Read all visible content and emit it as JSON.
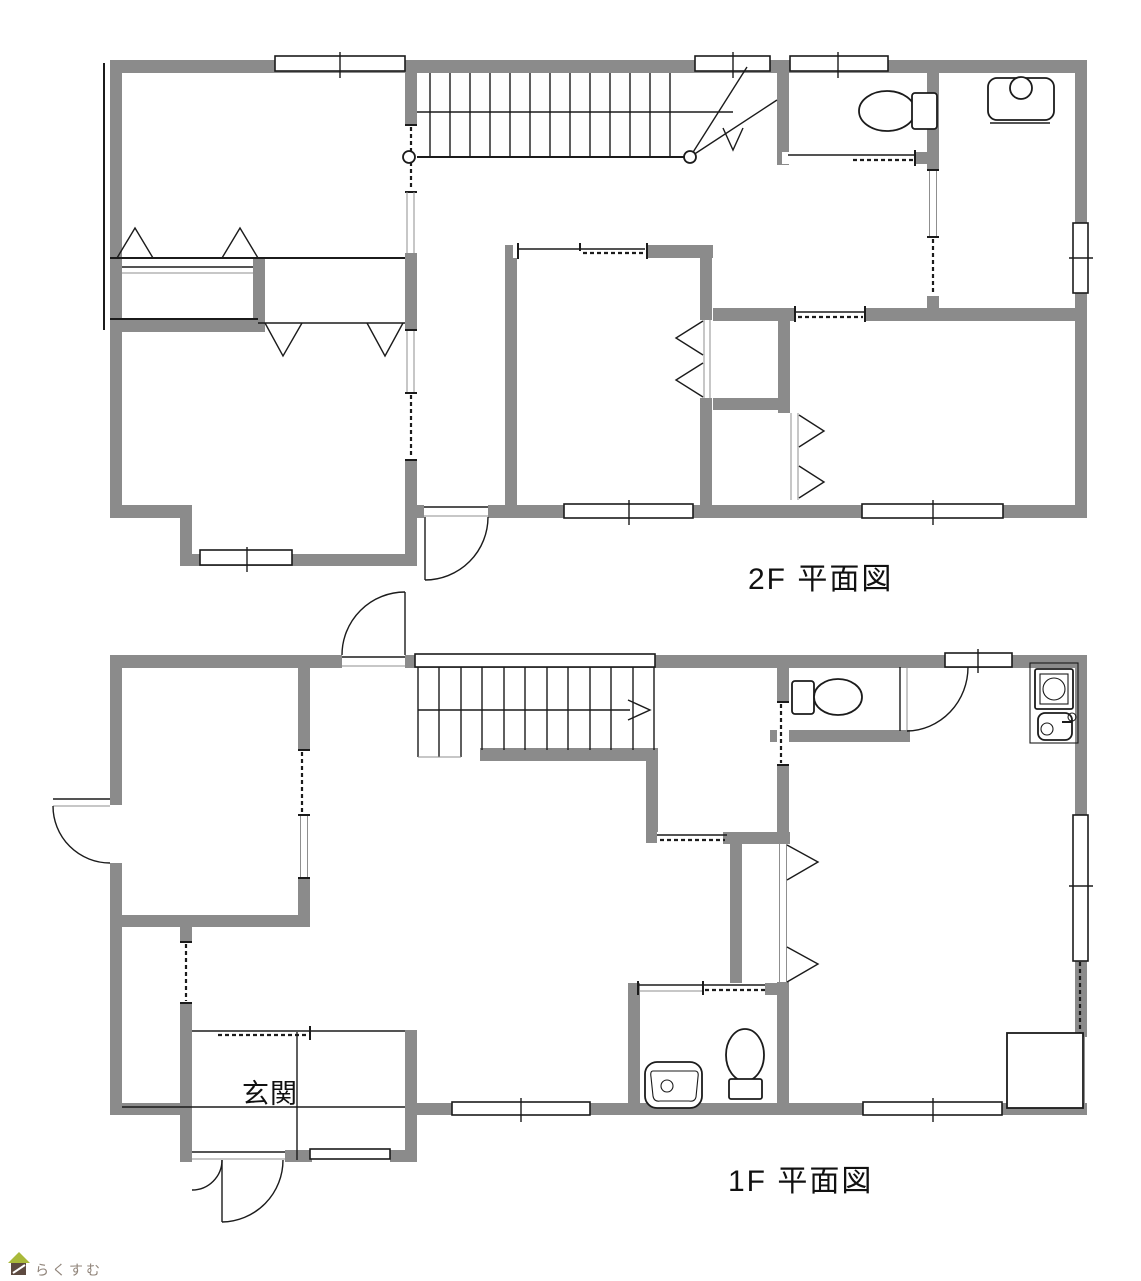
{
  "floors": [
    {
      "id": "2f",
      "label": "2F  平面図"
    },
    {
      "id": "1f",
      "label": "1F 平面図"
    }
  ],
  "rooms": {
    "entrance": "玄関"
  },
  "logo": {
    "text": "らくすむ"
  },
  "colors": {
    "wall": "#8b8b8b",
    "line": "#1b1b1b",
    "paper": "#ffffff",
    "logo_roof": "#a9b93a",
    "logo_body": "#5d4a40",
    "logo_text": "#90847a"
  },
  "icons": [
    "stairs-2f-icon",
    "stairs-1f-icon",
    "toilet-icon",
    "vanity-sink-icon",
    "kitchenette-icon",
    "washbasin-icon",
    "door-arc-icon",
    "house-logo-icon"
  ]
}
